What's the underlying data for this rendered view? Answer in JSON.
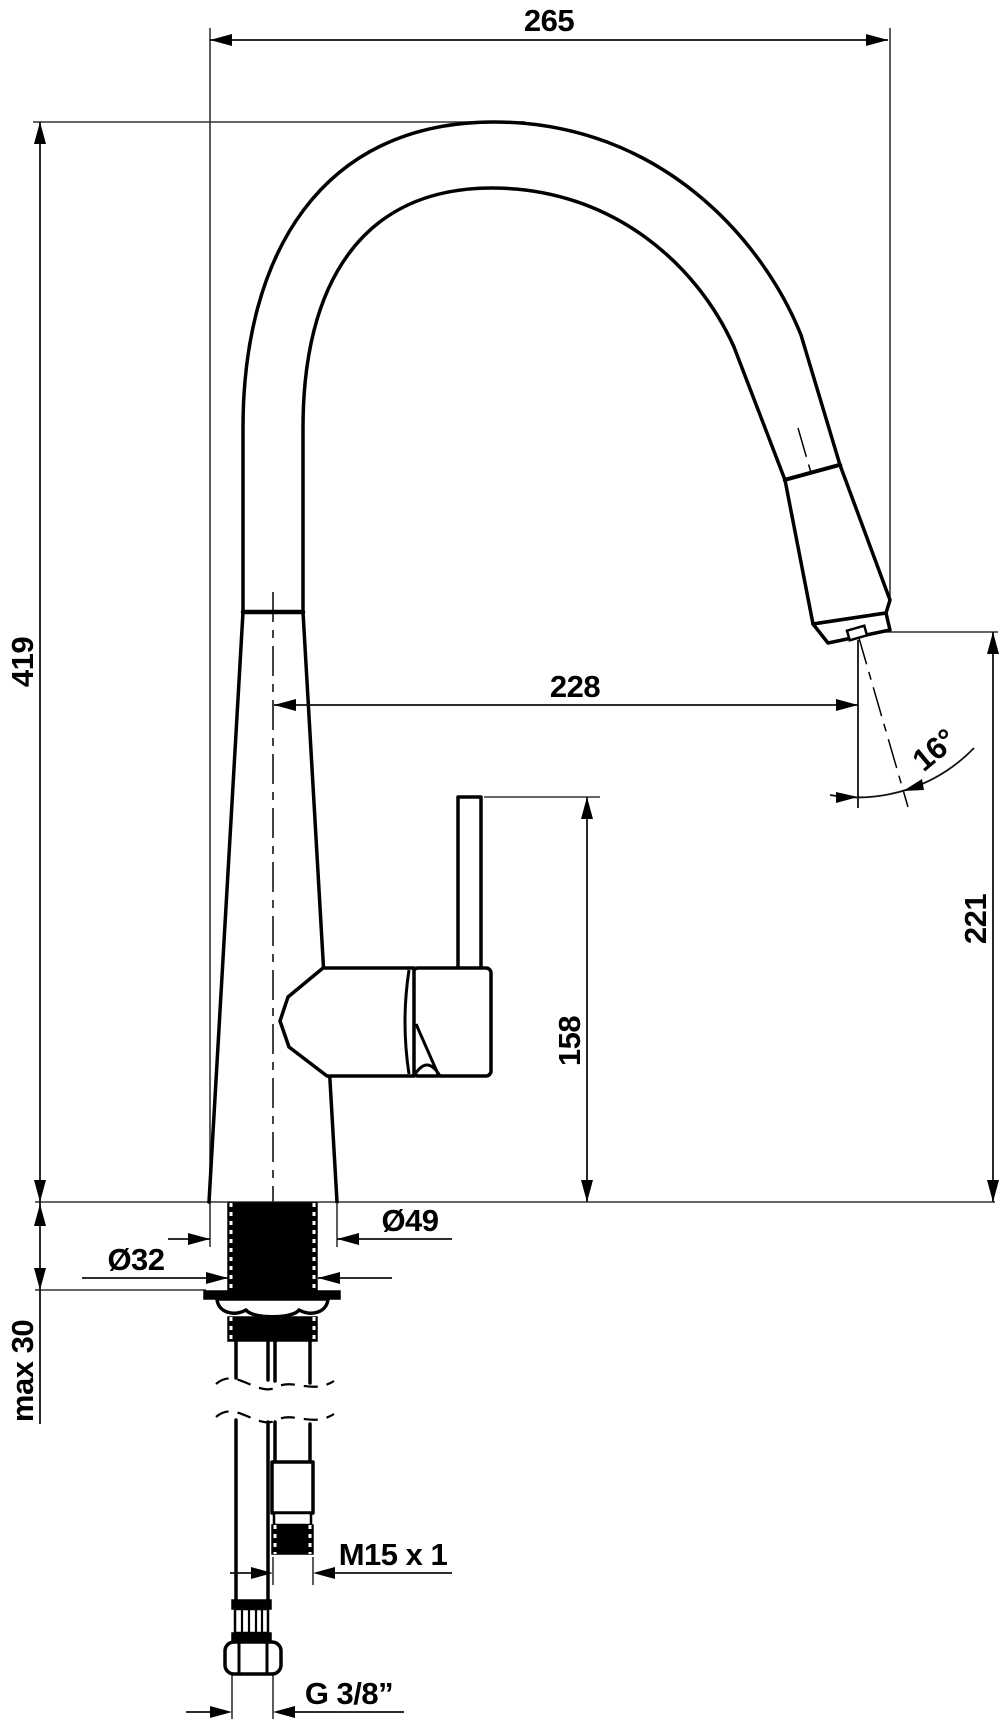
{
  "drawing": {
    "type": "technical-dimension-drawing",
    "subject": "single-lever kitchen mixer tap with pull-out spray head, side elevation with installation dimensions",
    "background_color": "#ffffff",
    "line_color": "#000000",
    "units": "mm",
    "dimensions": {
      "overall_width": "265",
      "overall_height": "419",
      "spout_reach": "228",
      "spray_angle": "16°",
      "outlet_height": "221",
      "lever_top_height": "158",
      "base_diameter": "Ø49",
      "mounting_shank_diameter": "Ø32",
      "max_counter_thickness": "max 30",
      "spray_hose_thread": "M15 x 1",
      "supply_hose_thread": "G 3/8”"
    }
  }
}
